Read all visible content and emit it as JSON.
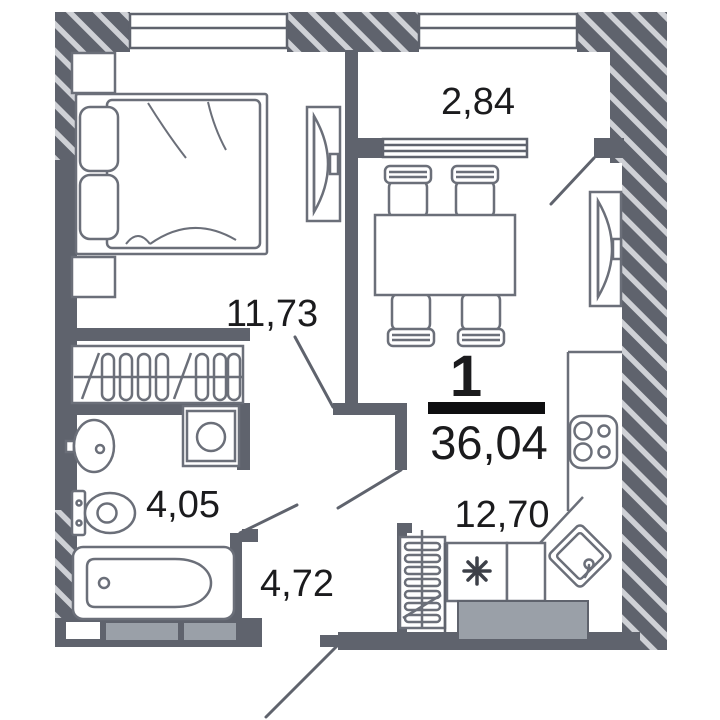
{
  "plan": {
    "type": "apartment-floor-plan",
    "summary": {
      "rooms_count": "1",
      "total_area": "36,04"
    },
    "rooms": [
      {
        "id": "balcony",
        "area": "2,84"
      },
      {
        "id": "bedroom",
        "area": "11,73"
      },
      {
        "id": "bathroom",
        "area": "4,05"
      },
      {
        "id": "hallway",
        "area": "4,72"
      },
      {
        "id": "kitchen-living",
        "area": "12,70"
      }
    ],
    "kitchen_symbol": "✳",
    "fixtures": [
      "double-bed",
      "pillows",
      "wardrobe-with-hangers",
      "bedroom-tv",
      "living-tv",
      "dining-table",
      "four-chairs",
      "stove-4-burners",
      "kitchen-corner-sink",
      "radiator",
      "washing-machine",
      "wash-basin",
      "toilet",
      "bathtub",
      "entrance-door-swing",
      "balcony-door-swing",
      "bedroom-door-swing",
      "bathroom-door-swing",
      "living-door-swing",
      "windows"
    ],
    "colors": {
      "wall": "#5f636d",
      "hatch_stripe": "#cfd1d6",
      "furniture": "#6b6f79",
      "text": "#1b1b1d",
      "light_fill": "#9aa0a8",
      "total_bar": "#0e0e10",
      "background": "#ffffff"
    }
  }
}
